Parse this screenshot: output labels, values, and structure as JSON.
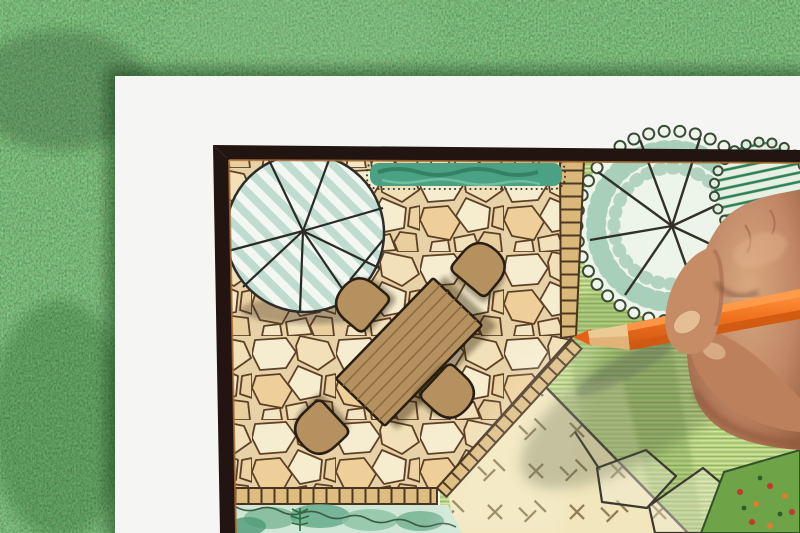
{
  "scene": {
    "setting": "Overhead photo of a hand drawing a garden landscape-architecture plan with an orange colored pencil; white paper sheet lies on green lawn grass",
    "objects": [
      {
        "id": "grass-background",
        "label": "Lawn grass background"
      },
      {
        "id": "paper-sheet",
        "label": "White drawing paper"
      },
      {
        "id": "plan-border",
        "label": "Dark plan border frame"
      },
      {
        "id": "flagstone-patio",
        "label": "Flagstone patio paving"
      },
      {
        "id": "round-tree-symbol",
        "label": "Round striped tree canopy symbol with branch spokes"
      },
      {
        "id": "hedge-strip",
        "label": "Teal hedge planting strip with dotted outline"
      },
      {
        "id": "garden-table",
        "label": "Rectangular plank garden table"
      },
      {
        "id": "garden-chair",
        "label": "Rounded garden chair symbol (x4)"
      },
      {
        "id": "brick-edging",
        "label": "Brick edging strips around patio"
      },
      {
        "id": "ladder-path",
        "label": "Runged edging path on patio right side"
      },
      {
        "id": "lawn-panel",
        "label": "Cream lawn panel with cross grading marks"
      },
      {
        "id": "garden-bed",
        "label": "Green hatched planting area"
      },
      {
        "id": "shade-tree-symbol",
        "label": "Large scalloped shade tree symbol"
      },
      {
        "id": "shrub-symbol",
        "label": "Hatched shrub symbol"
      },
      {
        "id": "boulder-outlines",
        "label": "Angular boulder outlines"
      },
      {
        "id": "flower-bed",
        "label": "Flower bed corner with red and orange blooms"
      },
      {
        "id": "plant-border",
        "label": "Watercolor plant border with fern"
      },
      {
        "id": "designer-hand",
        "label": "Designer's hand holding pencil"
      },
      {
        "id": "orange-pencil",
        "label": "Orange colored pencil"
      }
    ]
  },
  "palette": {
    "grass": "#47823f",
    "paper": "#f5f6f3",
    "frame": "#221410",
    "frame_inner_line": "#a86e33",
    "flagstone": "#e6d2a6",
    "stone_joint": "#5e4026",
    "brick": "#d9b87a",
    "hedge": "#4aa183",
    "tree_stripe": "#c0dcd0",
    "garden_green": "#d3e29e",
    "lawn": "#f2e6bd",
    "furniture": "#b5915f",
    "outline": "#2a1d12",
    "canopy_edge": "#3b4a36",
    "canopy_fill": "#edf4ea",
    "pencil_orange": "#f1731f",
    "pencil_wood": "#e2b378",
    "skin": "#c18767",
    "skin_shadow": "#8a5338"
  }
}
